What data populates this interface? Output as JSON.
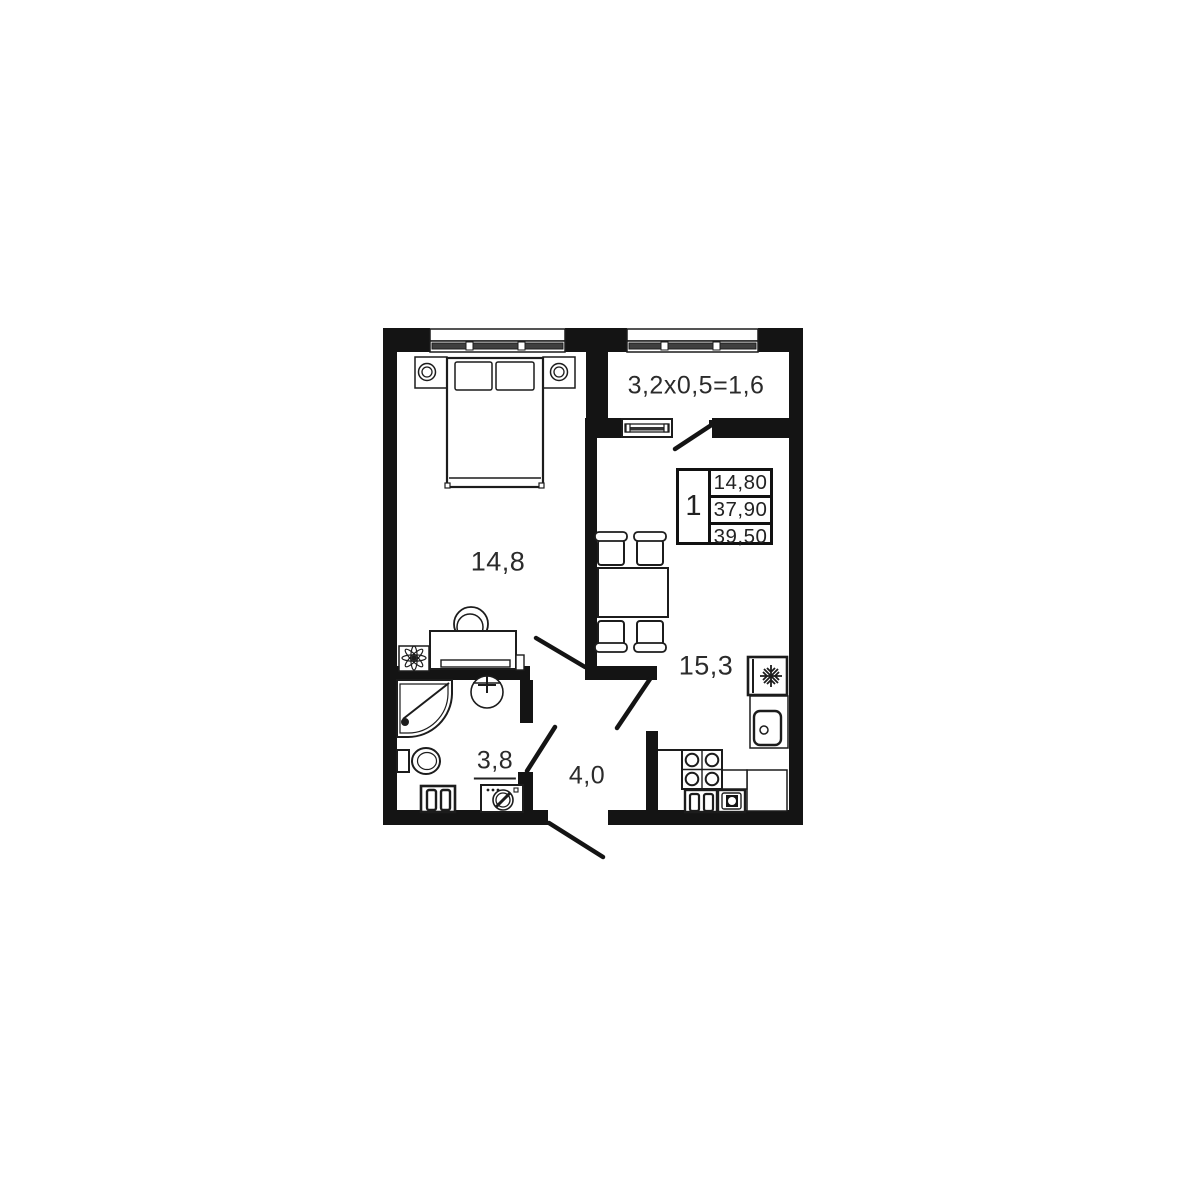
{
  "plan": {
    "balcony_dimensions": "3,2x0,5=1,6",
    "rooms": {
      "bedroom_area": "14,8",
      "kitchen_area": "15,3",
      "bathroom_area": "3,8",
      "hallway_area": "4,0"
    },
    "info_table": {
      "room_count": "1",
      "rows": [
        "14,80",
        "37,90",
        "39,50"
      ]
    },
    "colors": {
      "wall": "#141414",
      "line": "#1c1c1c",
      "glass_bar": "#3f3f3f",
      "background": "#ffffff"
    }
  }
}
